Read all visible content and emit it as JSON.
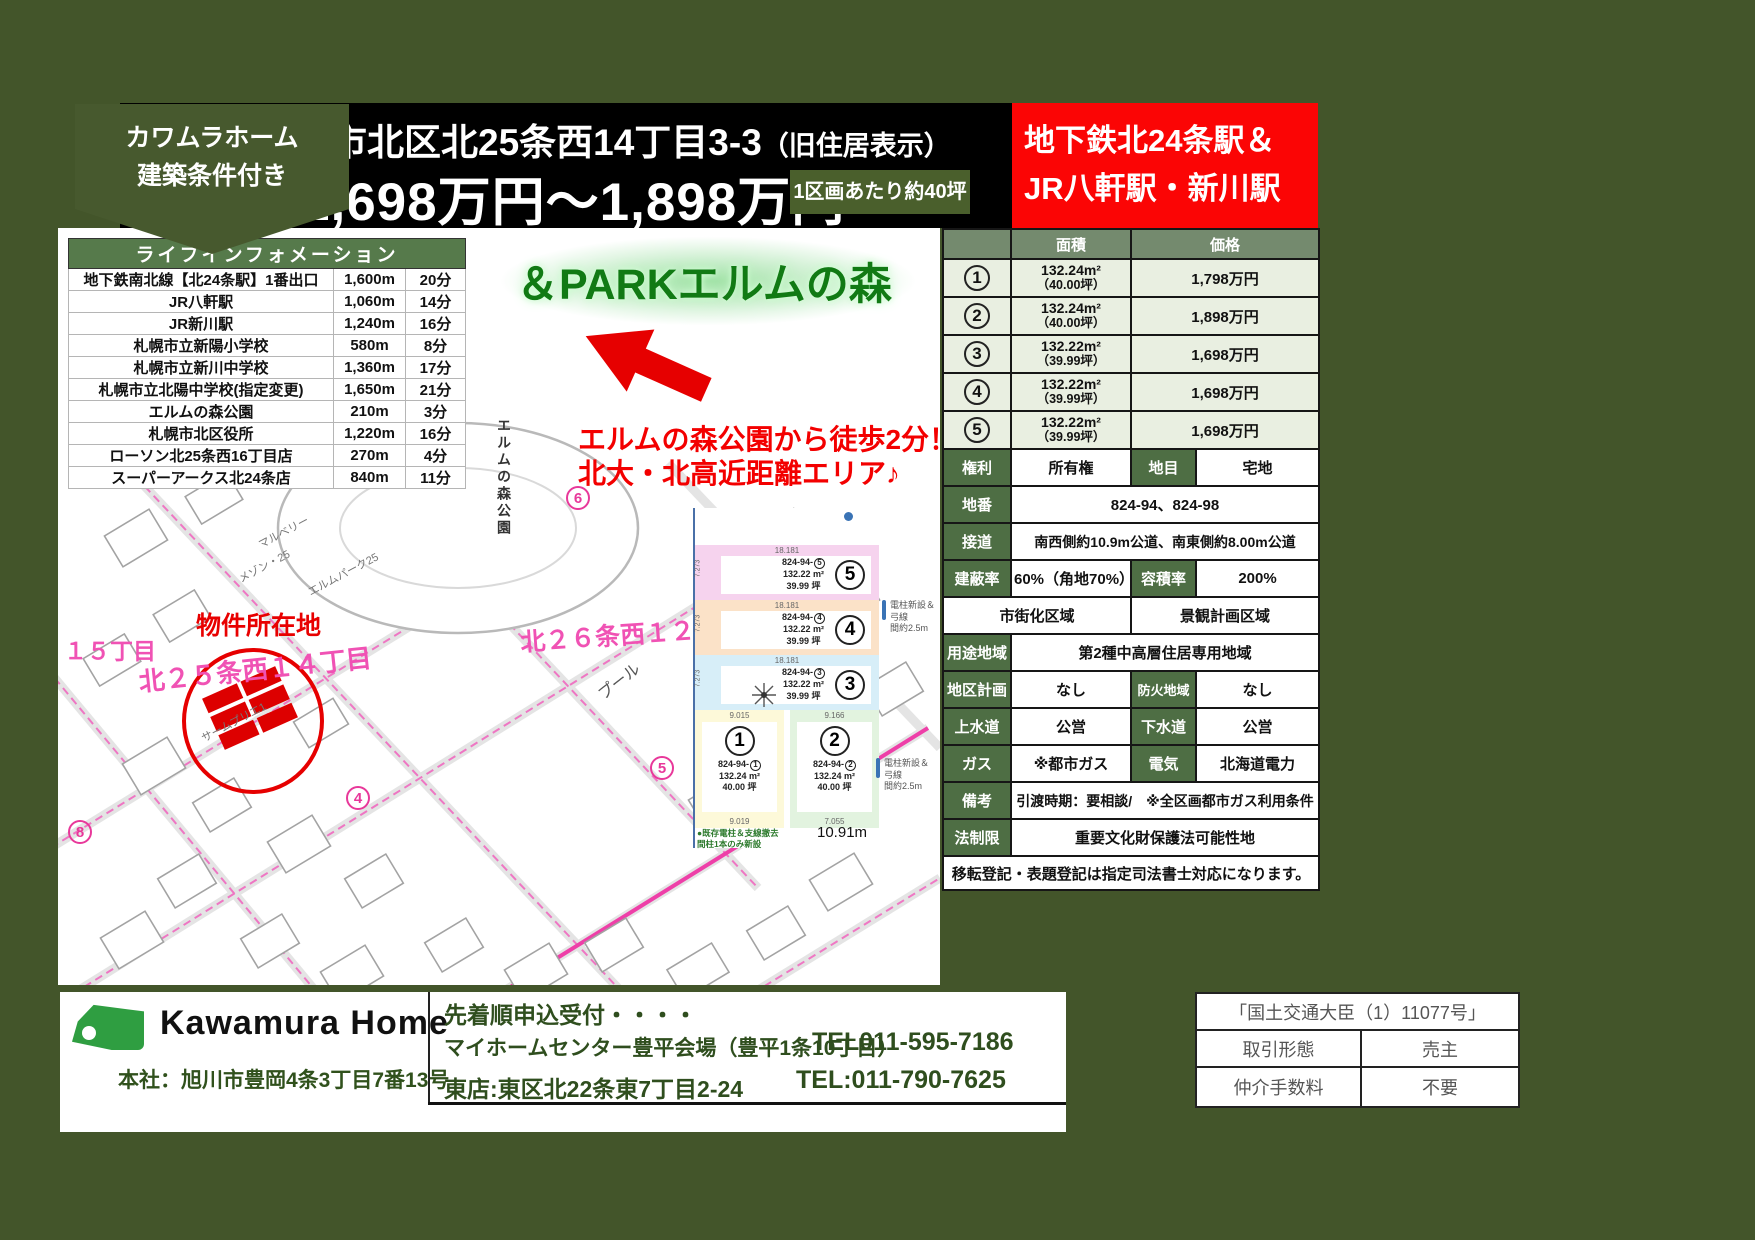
{
  "badge": {
    "line1": "カワムラホーム",
    "line2": "建築条件付き"
  },
  "header": {
    "address": "札幌市北区北25条西14丁目3-3",
    "address_note": "（旧住居表示）",
    "price_range": "1,698万円～1,898万円",
    "lot_note": "1区画あたり約40坪",
    "station_line1": "地下鉄北24条駅＆",
    "station_line2": "JR八軒駅・新川駅"
  },
  "life_info": {
    "title": "ライフインフォメーション",
    "rows": [
      {
        "name": "地下鉄南北線【北24条駅】1番出口",
        "distance": "1,600m",
        "time": "20分"
      },
      {
        "name": "JR八軒駅",
        "distance": "1,060m",
        "time": "14分"
      },
      {
        "name": "JR新川駅",
        "distance": "1,240m",
        "time": "16分"
      },
      {
        "name": "札幌市立新陽小学校",
        "distance": "580m",
        "time": "8分"
      },
      {
        "name": "札幌市立新川中学校",
        "distance": "1,360m",
        "time": "17分"
      },
      {
        "name": "札幌市立北陽中学校(指定変更)",
        "distance": "1,650m",
        "time": "21分"
      },
      {
        "name": "エルムの森公園",
        "distance": "210m",
        "time": "3分"
      },
      {
        "name": "札幌市北区役所",
        "distance": "1,220m",
        "time": "16分"
      },
      {
        "name": "ローソン北25条西16丁目店",
        "distance": "270m",
        "time": "4分"
      },
      {
        "name": "スーパーアークス北24条店",
        "distance": "840m",
        "time": "11分"
      }
    ]
  },
  "map": {
    "park_overlay": "＆PARKエルムの森",
    "catch1": "エルムの森公園から徒歩2分！",
    "catch2": "北大・北高近距離エリア♪",
    "site_label": "物件所在地",
    "street_15": "１５丁目",
    "street_25_14": "北２５条西１４丁目",
    "street_26_12": "北２６条西１２丁",
    "park_vertical": "エルムの森公園",
    "pool": "プール",
    "small_labels": [
      "マルベリー",
      "メゾン・25",
      "エルムパーク25",
      "サームプリエ1"
    ],
    "circled": [
      "6",
      "5",
      "4",
      "8",
      "3"
    ]
  },
  "site_plan": {
    "parcel_prefix": "824-94-",
    "lots": [
      {
        "no": "5",
        "area": "132.22 m²",
        "tsubo": "39.99 坪",
        "top": "18.181",
        "side": "7.273",
        "color": "#f6d3ee"
      },
      {
        "no": "4",
        "area": "132.22 m²",
        "tsubo": "39.99 坪",
        "top": "18.181",
        "side": "7.273",
        "color": "#fbe2c8"
      },
      {
        "no": "3",
        "area": "132.22 m²",
        "tsubo": "39.99 坪",
        "top": "18.181",
        "side": "7.273",
        "color": "#d7eef8"
      },
      {
        "no": "1",
        "area": "132.24 m²",
        "tsubo": "40.00 坪",
        "top": "9.015",
        "bottom": "9.019",
        "color": "#fdf9d9"
      },
      {
        "no": "2",
        "area": "132.24 m²",
        "tsubo": "40.00 坪",
        "top": "9.166",
        "bottom": "7.055",
        "color": "#e2f3df"
      }
    ],
    "bottom_width": "10.91m",
    "pole_note1": "電柱新設＆弓線\n間約2.5m",
    "pole_note2": "電柱新設＆弓線\n間約2.5m",
    "legend": "●既存電柱＆支線撤去\n間柱1本のみ新設"
  },
  "details": {
    "col_area": "面積",
    "col_price": "価格",
    "lots": [
      {
        "no": "1",
        "area": "132.24m²",
        "tsubo": "（40.00坪）",
        "price": "1,798万円"
      },
      {
        "no": "2",
        "area": "132.24m²",
        "tsubo": "（40.00坪）",
        "price": "1,898万円"
      },
      {
        "no": "3",
        "area": "132.22m²",
        "tsubo": "（39.99坪）",
        "price": "1,698万円"
      },
      {
        "no": "4",
        "area": "132.22m²",
        "tsubo": "（39.99坪）",
        "price": "1,698万円"
      },
      {
        "no": "5",
        "area": "132.22m²",
        "tsubo": "（39.99坪）",
        "price": "1,698万円"
      }
    ],
    "rights_label": "権利",
    "rights": "所有権",
    "land_cat_label": "地目",
    "land_cat": "宅地",
    "parcel_label": "地番",
    "parcel": "824-94、824-98",
    "road_label": "接道",
    "road": "南西側約10.9m公道、南東側約8.00m公道",
    "bcr_label": "建蔽率",
    "bcr": "60%（角地70%）",
    "far_label": "容積率",
    "far": "200%",
    "zone1": "市街化区域",
    "zone2": "景観計画区域",
    "use_label": "用途地域",
    "use": "第2種中高層住居専用地域",
    "district_label": "地区計画",
    "district": "なし",
    "fire_label": "防火地域",
    "fire": "なし",
    "water_label": "上水道",
    "water": "公営",
    "sewer_label": "下水道",
    "sewer": "公営",
    "gas_label": "ガス",
    "gas": "※都市ガス",
    "elec_label": "電気",
    "elec": "北海道電力",
    "remarks_label": "備考",
    "remarks": "引渡時期：要相談/　※全区画都市ガス利用条件",
    "law_label": "法制限",
    "law": "重要文化財保護法可能性地",
    "note": "移転登記・表題登記は指定司法書士対応になります。"
  },
  "footer": {
    "company": "Kawamura Home",
    "hq": "本社：旭川市豊岡4条3丁目7番13号",
    "accept": "先着順申込受付・・・・",
    "venue1": "マイホームセンター豊平会場（豊平1条10丁目）",
    "tel1": "TEL011-595-7186",
    "venue2": "東店:東区北22条東7丁目2-24",
    "tel2": "TEL:011-790-7625",
    "license": "「国土交通大臣（1）11077号」",
    "deal_type_label": "取引形態",
    "deal_type": "売主",
    "fee_label": "仲介手数料",
    "fee": "不要"
  },
  "colors": {
    "frame_green": "#43552a",
    "accent_red": "#fb0505",
    "label_green": "#4e6e44",
    "header_green": "#748a6e",
    "row_pale_green": "#e9efe1",
    "life_header_green": "#567a4b",
    "logo_green": "#2f9e41",
    "map_pink": "#f052b4"
  }
}
